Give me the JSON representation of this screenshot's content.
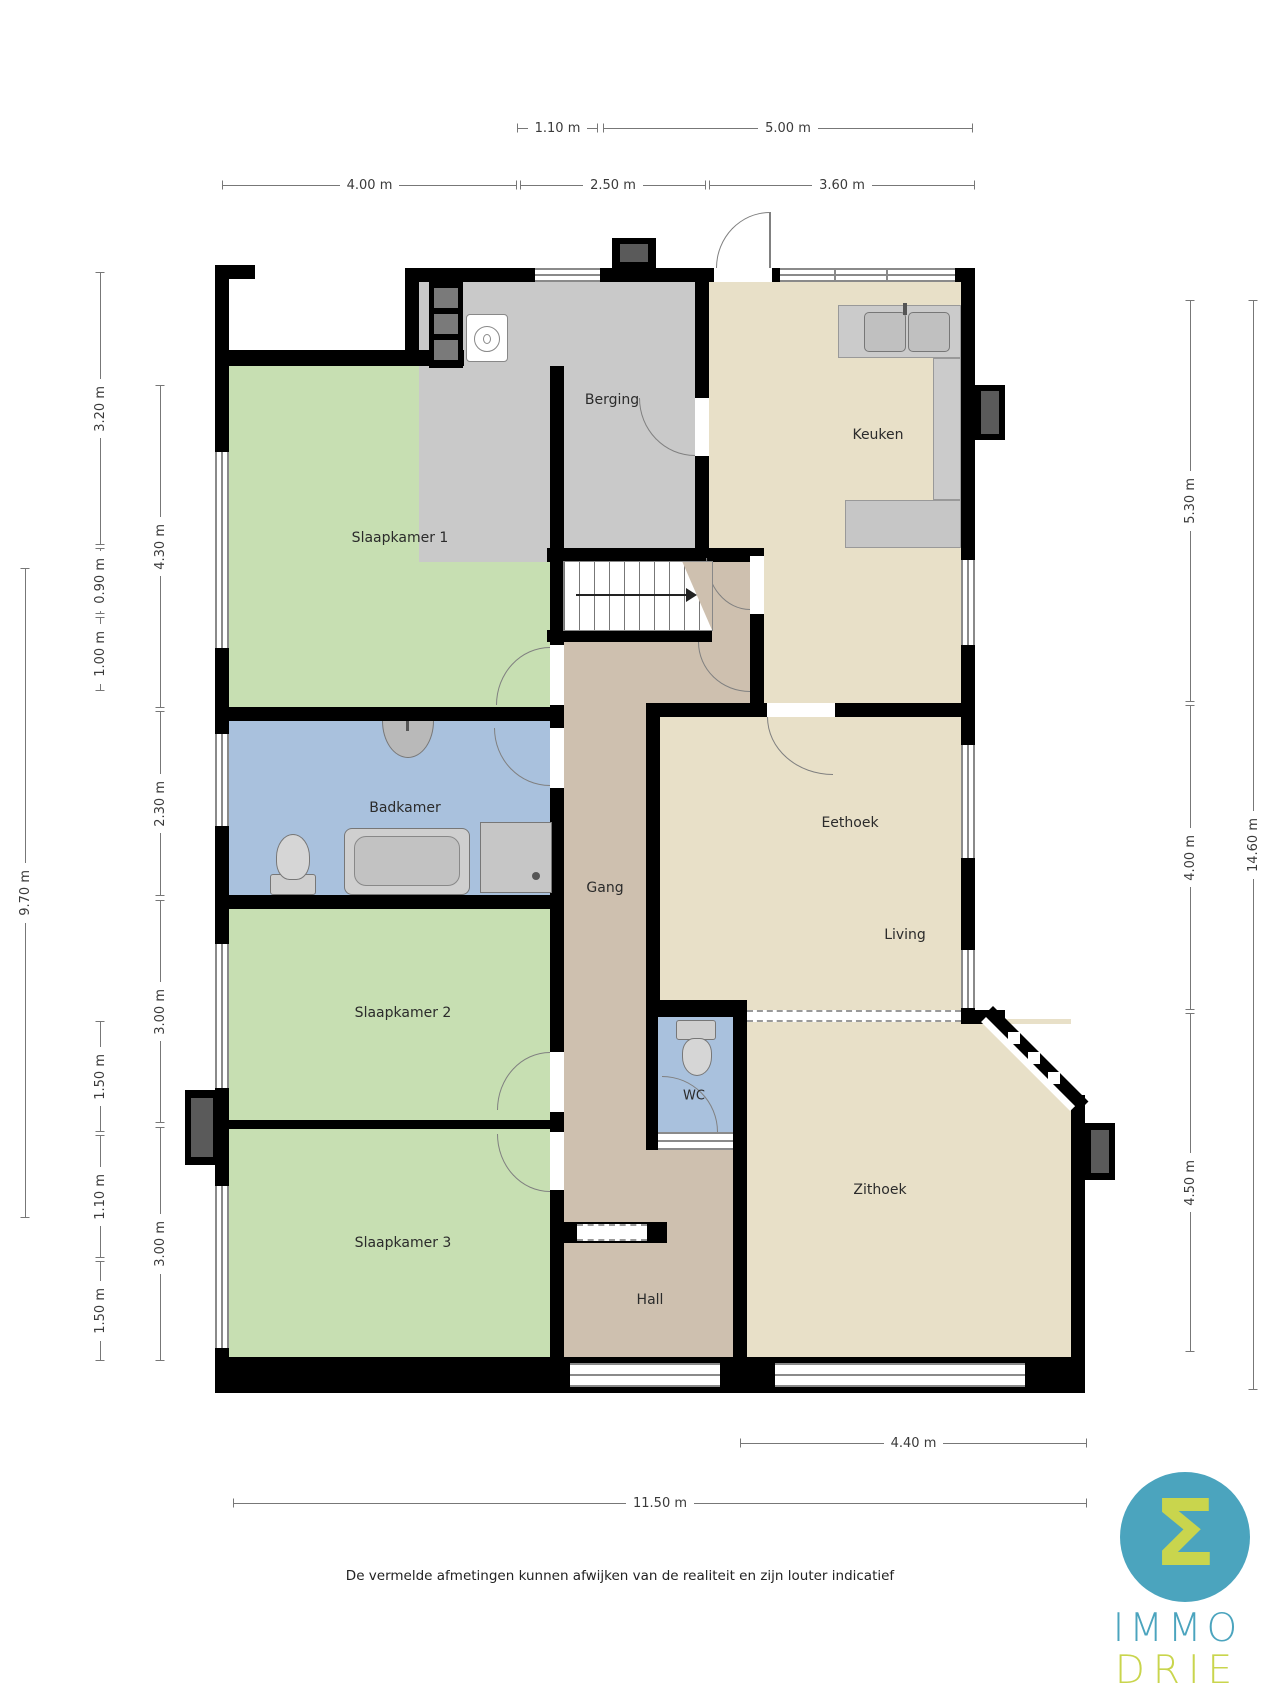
{
  "rooms": {
    "berging": "Berging",
    "keuken": "Keuken",
    "slaapkamer1": "Slaapkamer 1",
    "badkamer": "Badkamer",
    "gang": "Gang",
    "eethoek": "Eethoek",
    "living": "Living",
    "slaapkamer2": "Slaapkamer 2",
    "wc": "WC",
    "slaapkamer3": "Slaapkamer 3",
    "zithoek": "Zithoek",
    "hall": "Hall"
  },
  "dims": {
    "top_row1": [
      "1.10 m",
      "5.00 m"
    ],
    "top_row2": [
      "4.00 m",
      "2.50 m",
      "3.60 m"
    ],
    "left_outer": "9.70 m",
    "left_mid": [
      "3.20 m",
      "0.90 m",
      "1.00 m",
      "1.50 m",
      "1.10 m",
      "1.50 m"
    ],
    "left_inner": [
      "4.30 m",
      "2.30 m",
      "3.00 m",
      "3.00 m"
    ],
    "right_inner": [
      "5.30 m",
      "4.00 m",
      "4.50 m"
    ],
    "right_outer": "14.60 m",
    "bottom": [
      "4.40 m",
      "11.50 m"
    ]
  },
  "footer": {
    "disclaimer": "De vermelde afmetingen kunnen afwijken van de realiteit en zijn louter indicatief"
  },
  "logo": {
    "symbol": "Σ",
    "word_top": "IMMO",
    "word_bottom": "DRIE"
  },
  "colors": {
    "wall": "#000000",
    "room_green": "#c7dfb2",
    "room_blue": "#a9c1dd",
    "room_cream": "#e8e0c8",
    "room_gray": "#c9c9c9",
    "room_tan": "#cec0af",
    "counter_gray": "#cbcbcb",
    "logo_teal": "#4ba4be",
    "logo_green": "#c9d54d"
  }
}
